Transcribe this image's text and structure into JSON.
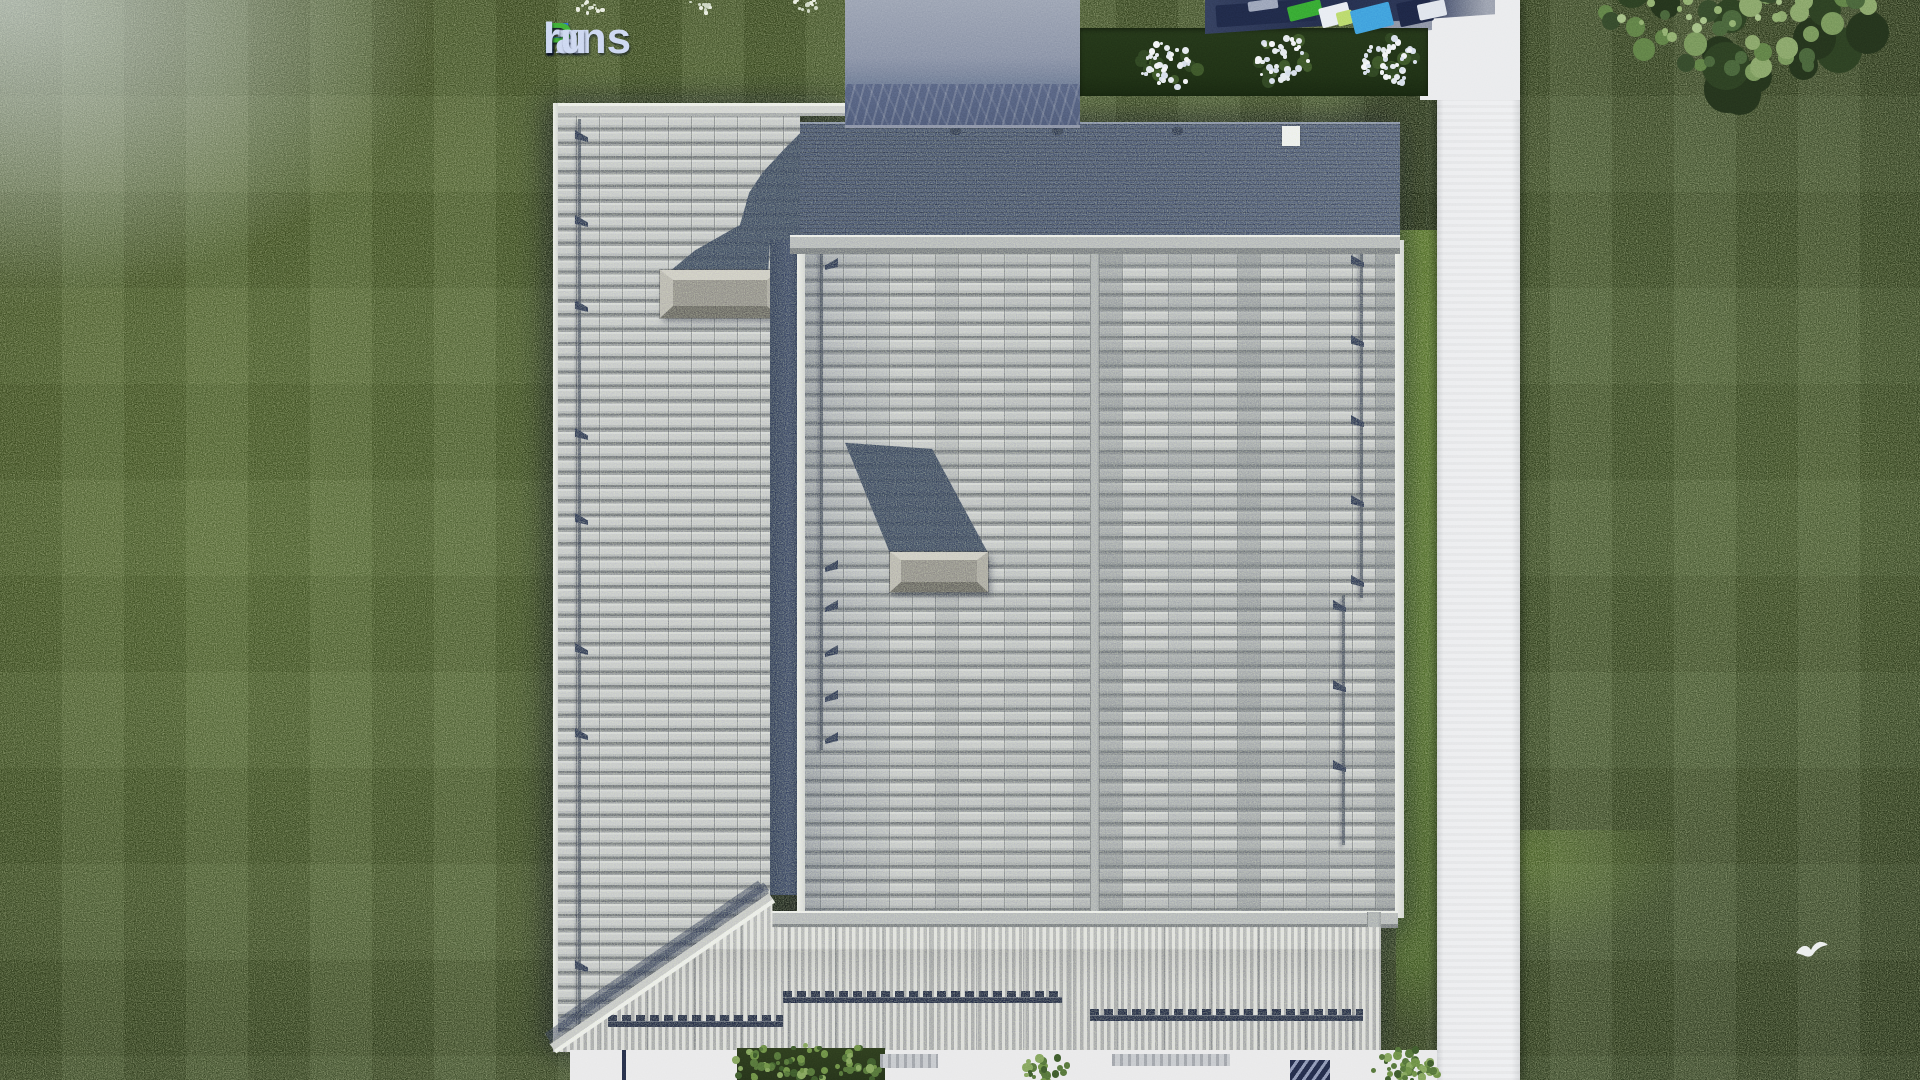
{
  "logo": {
    "text": "FixPlans.ru",
    "segments": [
      {
        "text": "F",
        "color": "#2f72d8"
      },
      {
        "text": "ix",
        "color": "#ccd7f1"
      },
      {
        "text": "P",
        "color": "#3fae35"
      },
      {
        "text": "lans",
        "color": "#ccd7f1"
      },
      {
        "text": ".",
        "color": "#2f72d8"
      },
      {
        "text": "ru",
        "color": "#ccd7f1"
      }
    ]
  },
  "palette": {
    "grass": "#3a4b20",
    "grass_dark": "#2c3b1b",
    "grass_bright": "#5a7631",
    "bed_green": "#22341a",
    "roof_tile_light": "#c4c6cb",
    "roof_tile_gap": "#63666d",
    "roof_shadow_navy": "#2d3955",
    "flat_roof_navy": "#414d6b",
    "ridge_bar": "#a9acb2",
    "veranda_light": "#dbdbdd",
    "veranda_grey": "#a0a1a7",
    "zigzag_navy": "#1d2540",
    "chimney_grey": "#8a8784",
    "path_white": "#ecedef",
    "driveway_grey": "#717d96",
    "furniture_blue": "#3f9fdc",
    "furniture_green": "#36a832",
    "bush_white": "#f2f4f6",
    "bush_green": "#6d8f46"
  }
}
